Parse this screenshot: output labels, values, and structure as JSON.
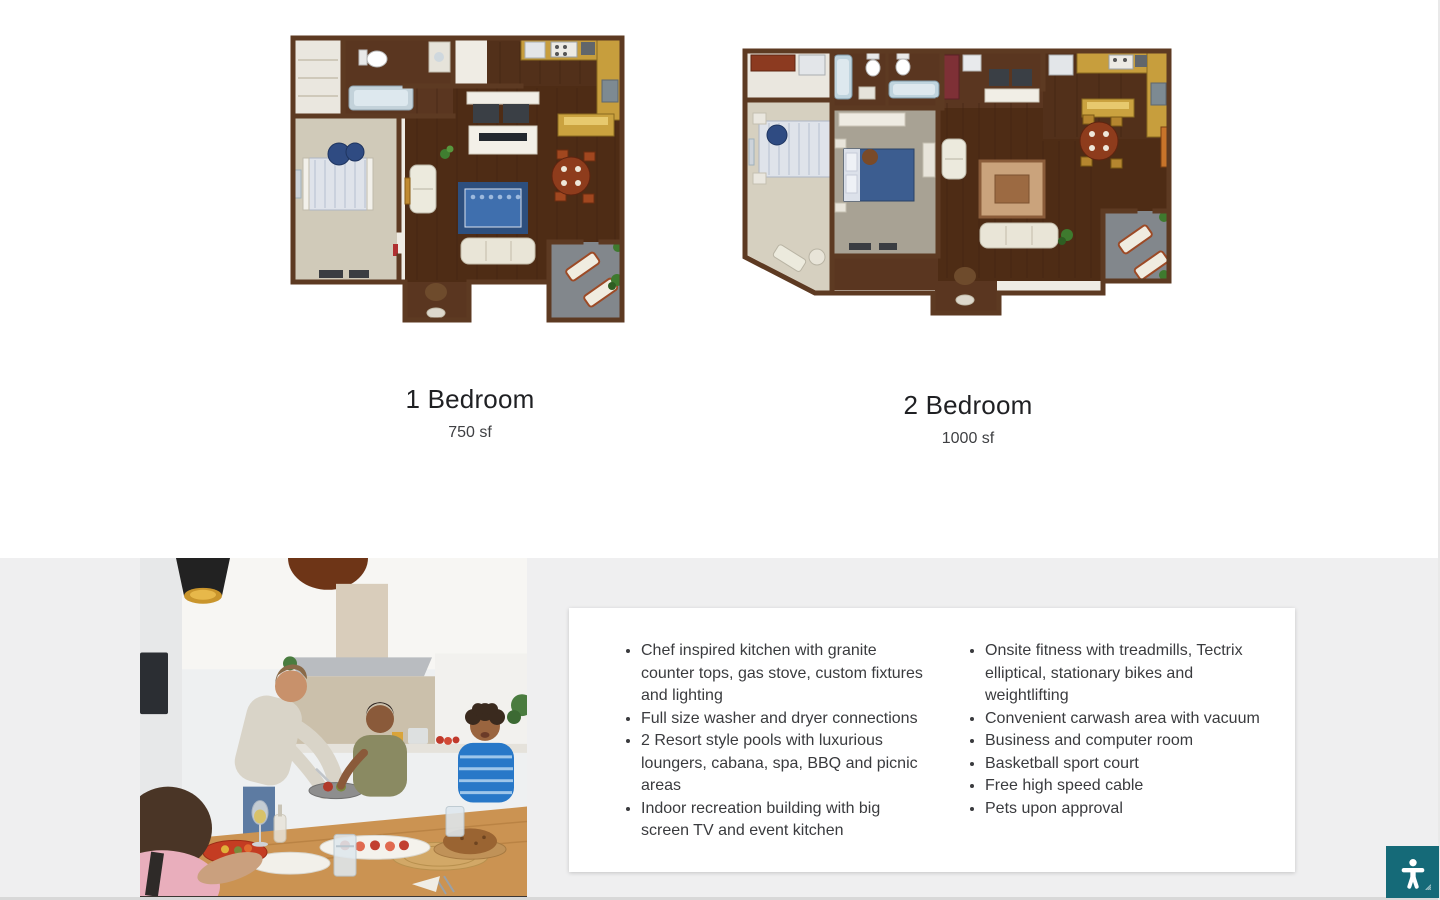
{
  "floorplans": {
    "plans": [
      {
        "title": "1 Bedroom",
        "size": "750 sf"
      },
      {
        "title": "2 Bedroom",
        "size": "1000 sf"
      }
    ]
  },
  "amenities": {
    "left_column": [
      "Chef inspired kitchen with granite counter tops, gas stove, custom fixtures and lighting",
      "Full size washer and dryer connections",
      "2 Resort style pools with luxurious loungers, cabana, spa, BBQ and picnic areas",
      "Indoor recreation building with big screen TV and event kitchen"
    ],
    "right_column": [
      "Onsite fitness with treadmills, Tectrix elliptical, stationary bikes and weightlifting",
      "Convenient carwash area with vacuum",
      "Business and computer room",
      "Basketball sport court",
      "Free high speed cable",
      "Pets upon approval"
    ]
  },
  "accessibility_widget": {
    "icon": "accessibility-person-icon",
    "color": "#156a78"
  },
  "colors": {
    "page_bg": "#ffffff",
    "lower_section_bg": "#efeff0",
    "card_bg": "#ffffff",
    "heading_text": "#1f2023",
    "body_text": "#3a3b3e"
  }
}
